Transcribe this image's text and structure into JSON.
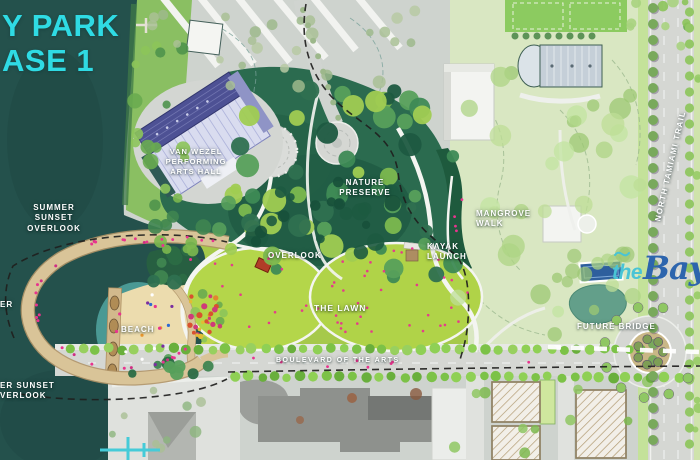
{
  "title": {
    "line1": "Y PARK",
    "line2": "ASE 1"
  },
  "labels": {
    "van_wezel": "VAN WEZEL\nPERFORMING\nARTS HALL",
    "summer_sunset_overlook": "SUMMER SUNSET\nOVERLOOK",
    "nature_preserve": "NATURE\nPRESERVE",
    "overlook": "OVERLOOK",
    "the_lawn": "THE LAWN",
    "beach": "BEACH",
    "boulevard_of_the_arts": "BOULEVARD OF THE ARTS",
    "kayak_launch": "KAYAK\nLAUNCH",
    "mangrove_walk": "MANGROVE\nWALK",
    "future_bridge": "FUTURE BRIDGE",
    "winter_sunset_overlook_fragment": "ER SUNSET\nVERLOOK",
    "pier_fragment": "ER",
    "north_tamiami_trail": "NORTH TAMIAMI TRAIL"
  },
  "logo": {
    "the": "the",
    "bay": "Bay"
  },
  "colors": {
    "title_cyan": "#2fdbe4",
    "water": "#24514c",
    "preserve_green": "#2b6b4f",
    "lawn_green": "#aecd3f",
    "sand": "#ecdcae",
    "boardwalk_tan": "#d9c498",
    "people_pink": "#e8348e",
    "logo_the_blue": "#49c4d5",
    "logo_bay_blue": "#2d65ad"
  }
}
